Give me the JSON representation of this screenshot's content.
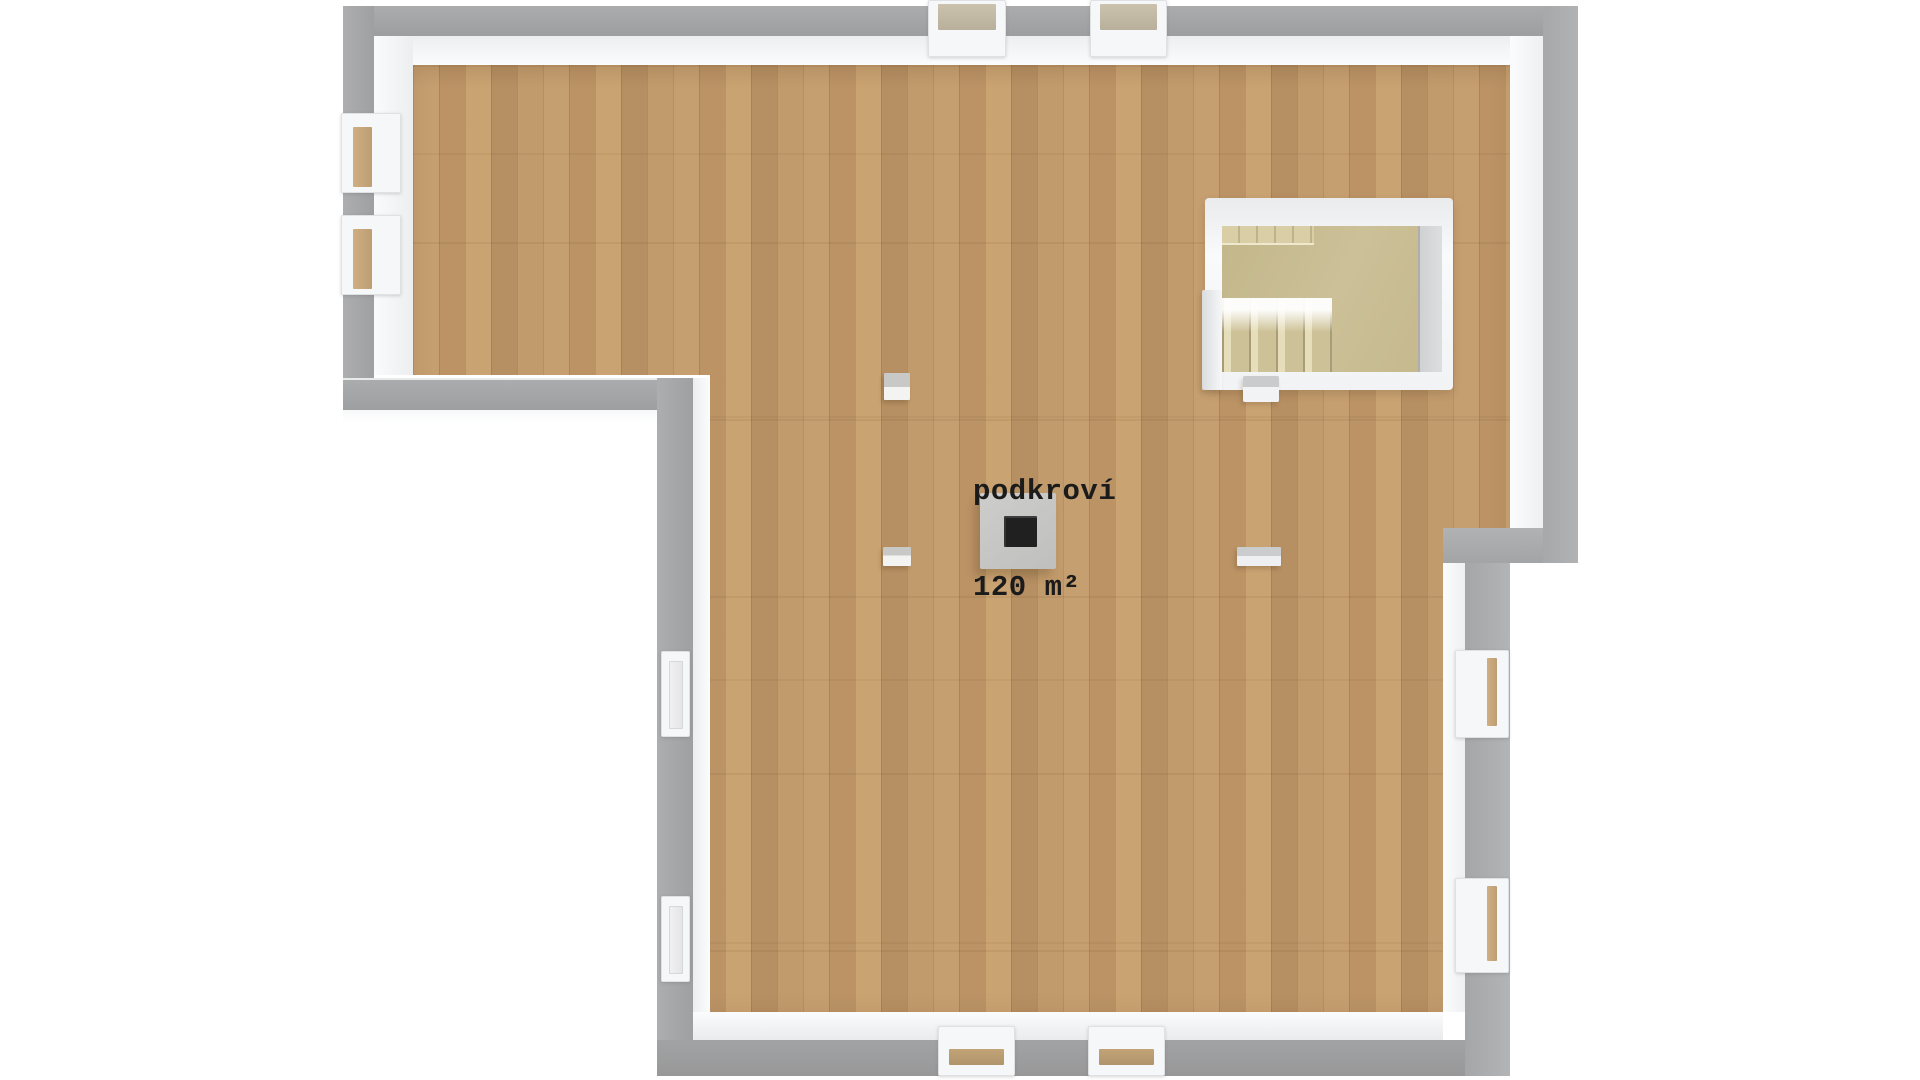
{
  "room": {
    "name": "podkroví",
    "area": "120 m²"
  },
  "palette": {
    "background": "#ffffff",
    "wall_outer_gray": "#a5a6a7",
    "wall_inner_white": "#f3f4f5",
    "floor_wood": "#c09a6b",
    "stairwell_interior": "#c8bb90",
    "chimney_body": "#c7c7c5",
    "chimney_flue": "#202020",
    "window_pane_tan": "#c0a47c",
    "label_text": "#1b1b1b"
  },
  "inventory": {
    "windows_top_wall": 2,
    "windows_bottom_wall": 2,
    "windows_left_upper_wall": 2,
    "windows_left_lower_wall": 2,
    "windows_right_lower_wall": 2,
    "staircases": 1,
    "chimneys": 1,
    "posts": 3
  }
}
